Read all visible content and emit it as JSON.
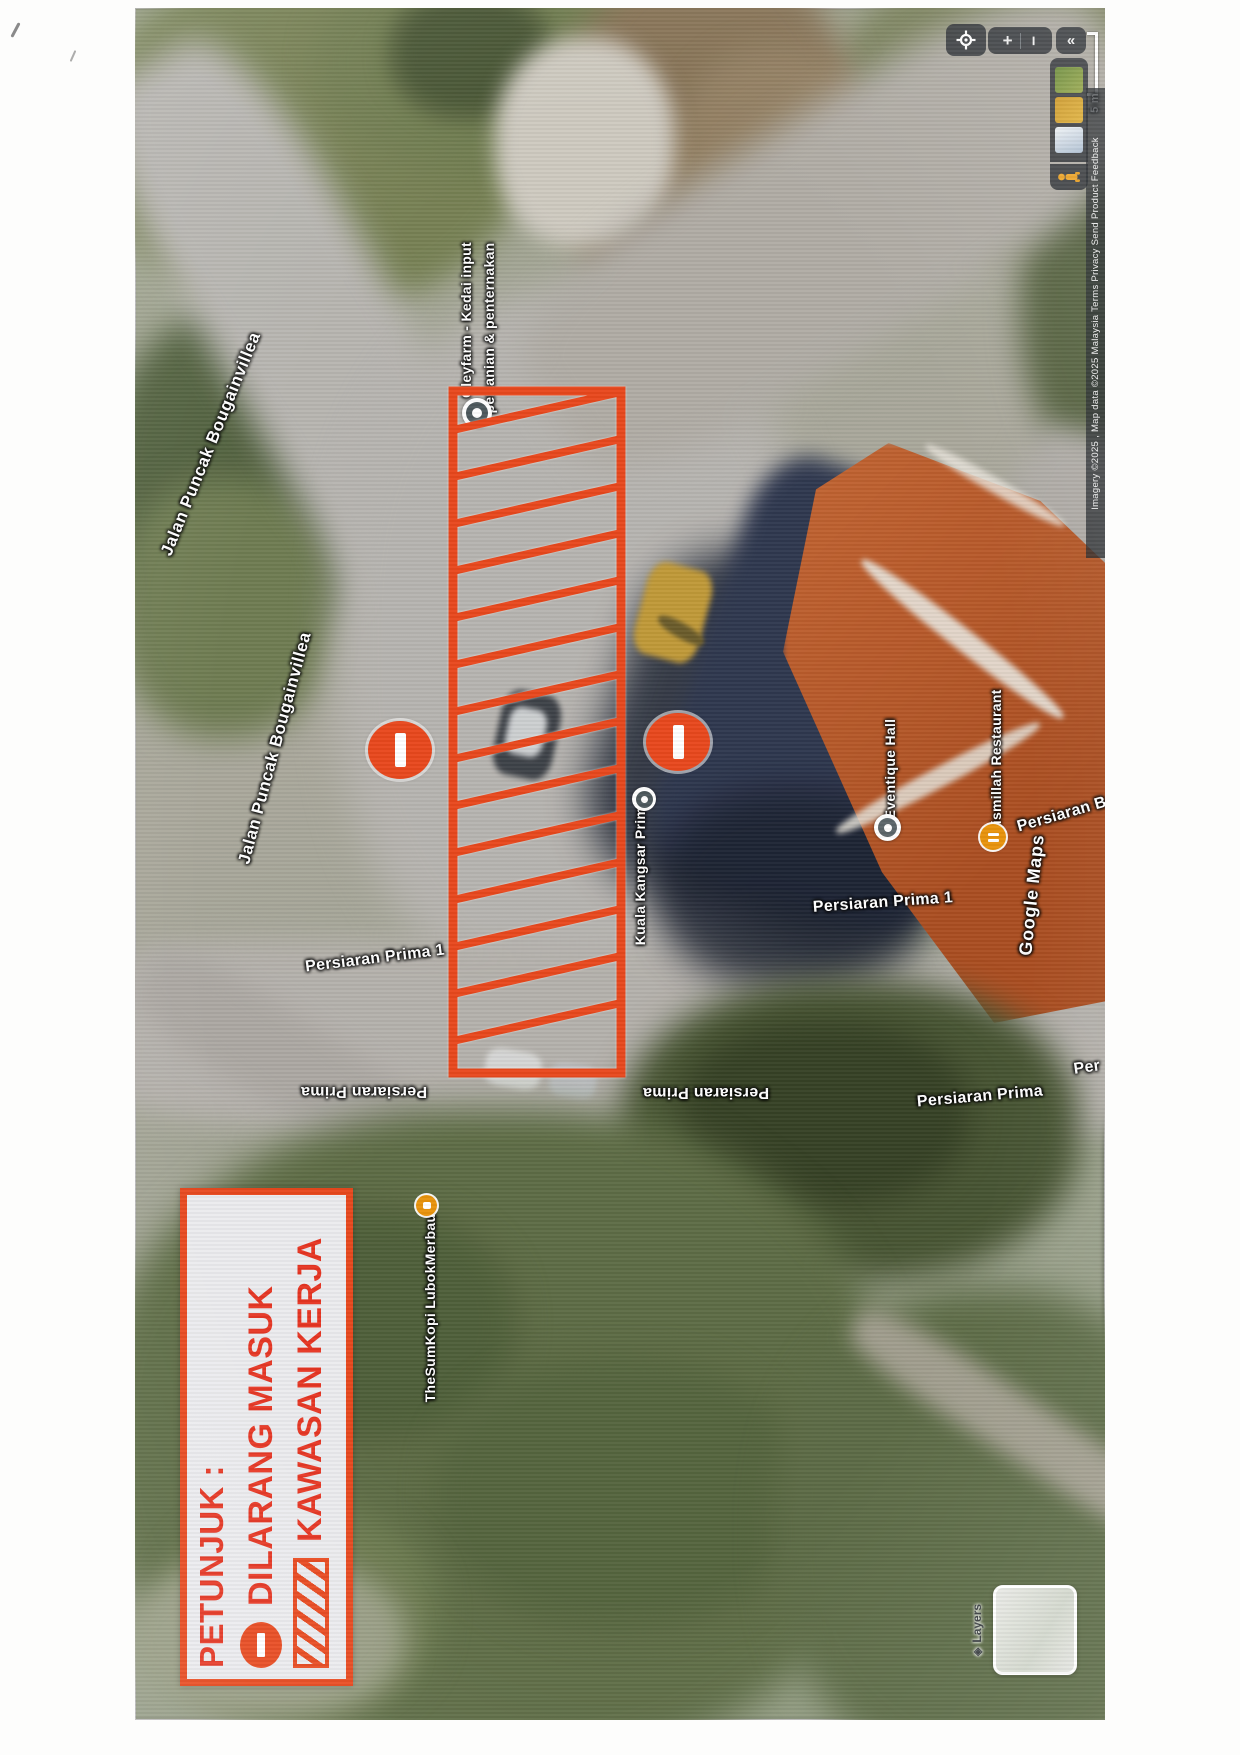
{
  "map_ui": {
    "zoom_in_glyph": "+",
    "zoom_out_glyph": "−",
    "collapse_glyph": "«",
    "layers_stack_glyph": "◈",
    "scale_label": "5 m",
    "brand": "Google Maps",
    "attribution": "Imagery ©2025 , Map data ©2025      Malaysia      Terms      Privacy      Send Product Feedback",
    "layers_label": "Layers"
  },
  "road_labels": {
    "jalan_puncak_top": "Jalan Puncak Bougainvillea",
    "jalan_puncak_mid": "Jalan Puncak Bougainvillea",
    "persiaran_prima1_left": "Persiaran Prima 1",
    "persiaran_prima1_right": "Persiaran Prima 1",
    "persiaran_prima_flip_left": "Persiaran Prima",
    "persiaran_prima_flip_right": "Persiaran Prima",
    "persiaran_prima_right": "Persiaran Prima",
    "persiaran_partial": "Persiaran B",
    "per_partial": "Per"
  },
  "poi_labels": {
    "farm_line1": "Gleyfarm - Kedai input",
    "farm_line2": "pertanian & penternakan",
    "kuala_kangsar_prima": "Kuala Kangsar Prima",
    "eventique_hall": "Eventique Hall",
    "bismillah_restaurant": "Bismillah Restaurant",
    "thesumkopi": "TheSumKopi LubokMerbau"
  },
  "legend": {
    "title": "PETUNJUK :",
    "no_entry_label": "DILARANG MASUK",
    "work_area_label": "KAWASAN KERJA"
  },
  "colors": {
    "annotation_red": "#e8481d",
    "legend_text_red": "#e63522",
    "restaurant_orange": "#e8930c",
    "control_dark": "#32363a"
  }
}
